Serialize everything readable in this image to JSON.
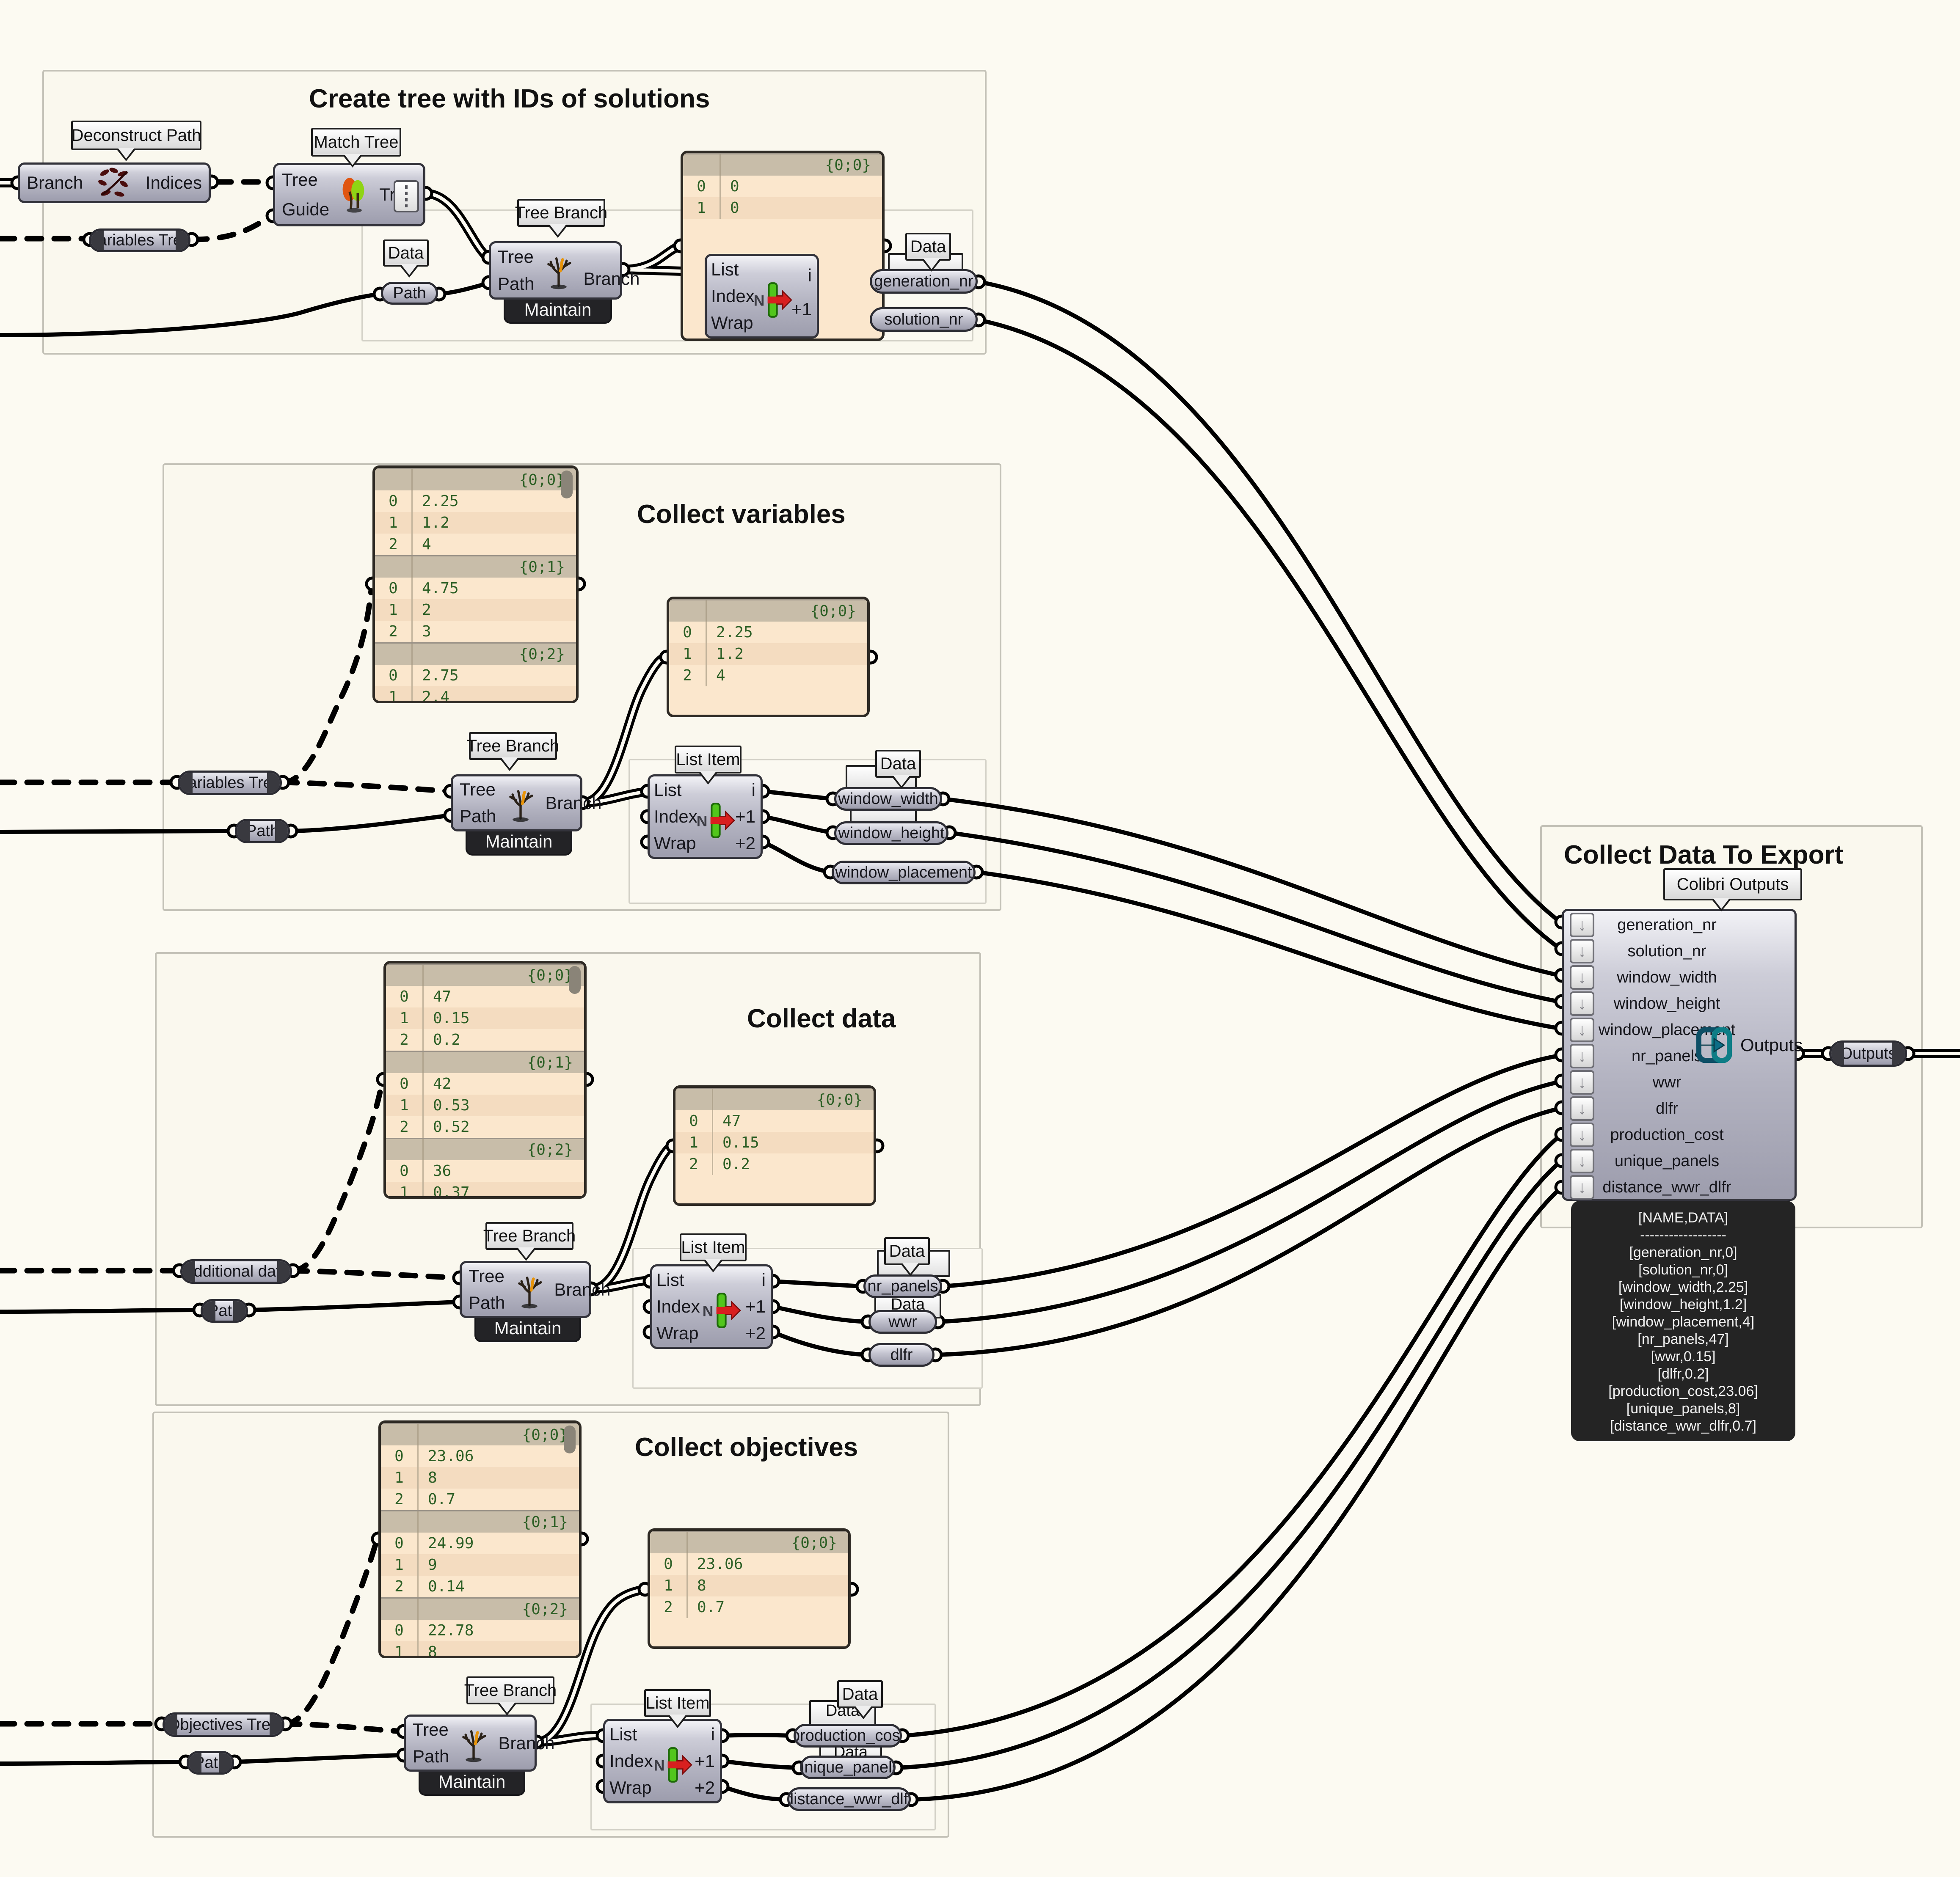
{
  "groups": {
    "g1": {
      "title": "Create tree with IDs of solutions"
    },
    "g2": {
      "title": "Collect variables"
    },
    "g3": {
      "title": "Collect data"
    },
    "g4": {
      "title": "Collect objectives"
    },
    "g5": {
      "title": "Collect Data To Export"
    }
  },
  "tooltips": {
    "deconstruct_path": "Deconstruct Path",
    "match_tree": "Match Tree",
    "tree_branch": "Tree Branch",
    "list_item": "List Item",
    "data": "Data",
    "colibri_outputs": "Colibri Outputs"
  },
  "components": {
    "deconstruct_path": {
      "input": "Branch",
      "output": "Indices"
    },
    "match_tree": {
      "inputs": [
        "Tree",
        "Guide"
      ],
      "output": "Tree"
    },
    "tree_branch": {
      "inputs": [
        "Tree",
        "Path"
      ],
      "output": "Branch",
      "footer": "Maintain"
    },
    "list_item": {
      "inputs": [
        "List",
        "Index",
        "Wrap"
      ],
      "icon_letter": "N",
      "outputs": [
        "i",
        "+1",
        "+2"
      ]
    },
    "colibri": {
      "inputs": [
        "generation_nr",
        "solution_nr",
        "window_width",
        "window_height",
        "window_placement",
        "nr_panels",
        "wwr",
        "dlfr",
        "production_cost",
        "unique_panels",
        "distance_wwr_dlfr"
      ],
      "output": "Outputs"
    }
  },
  "params": {
    "variables_tree": "Variables Tree",
    "additional_data": "Additional data",
    "objectives_tree": "Objectives Tree",
    "path": "Path",
    "generation_nr": "generation_nr",
    "solution_nr": "solution_nr",
    "window_width": "window_width",
    "window_height": "window_height",
    "window_placement": "window_placement",
    "nr_panels": "nr_panels",
    "wwr": "wwr",
    "dlfr": "dlfr",
    "production_cost": "production_cost",
    "unique_panels": "unique_panels",
    "distance_wwr_dlfr": "distance_wwr_dlfr",
    "outputs": "Outputs"
  },
  "panels": {
    "ids": {
      "rows": [
        {
          "c": "phdr",
          "i": "",
          "v": "{0;0}"
        },
        {
          "c": "prow",
          "i": "0",
          "v": "0"
        },
        {
          "c": "prow alt",
          "i": "1",
          "v": "0"
        }
      ]
    },
    "variables_big": {
      "rows": [
        {
          "c": "phdr",
          "i": "",
          "v": "{0;0}"
        },
        {
          "c": "prow",
          "i": "0",
          "v": "2.25"
        },
        {
          "c": "prow alt",
          "i": "1",
          "v": "1.2"
        },
        {
          "c": "prow",
          "i": "2",
          "v": "4"
        },
        {
          "c": "phdr",
          "i": "",
          "v": "{0;1}"
        },
        {
          "c": "prow",
          "i": "0",
          "v": "4.75"
        },
        {
          "c": "prow alt",
          "i": "1",
          "v": "2"
        },
        {
          "c": "prow",
          "i": "2",
          "v": "3"
        },
        {
          "c": "phdr",
          "i": "",
          "v": "{0;2}"
        },
        {
          "c": "prow",
          "i": "0",
          "v": "2.75"
        },
        {
          "c": "prow alt",
          "i": "1",
          "v": "2.4"
        }
      ]
    },
    "variables_small": {
      "rows": [
        {
          "c": "phdr",
          "i": "",
          "v": "{0;0}"
        },
        {
          "c": "prow",
          "i": "0",
          "v": "2.25"
        },
        {
          "c": "prow alt",
          "i": "1",
          "v": "1.2"
        },
        {
          "c": "prow",
          "i": "2",
          "v": "4"
        }
      ]
    },
    "data_big": {
      "rows": [
        {
          "c": "phdr",
          "i": "",
          "v": "{0;0}"
        },
        {
          "c": "prow",
          "i": "0",
          "v": "47"
        },
        {
          "c": "prow alt",
          "i": "1",
          "v": "0.15"
        },
        {
          "c": "prow",
          "i": "2",
          "v": "0.2"
        },
        {
          "c": "phdr",
          "i": "",
          "v": "{0;1}"
        },
        {
          "c": "prow",
          "i": "0",
          "v": "42"
        },
        {
          "c": "prow alt",
          "i": "1",
          "v": "0.53"
        },
        {
          "c": "prow",
          "i": "2",
          "v": "0.52"
        },
        {
          "c": "phdr",
          "i": "",
          "v": "{0;2}"
        },
        {
          "c": "prow",
          "i": "0",
          "v": "36"
        },
        {
          "c": "prow alt",
          "i": "1",
          "v": "0.37"
        }
      ]
    },
    "data_small": {
      "rows": [
        {
          "c": "phdr",
          "i": "",
          "v": "{0;0}"
        },
        {
          "c": "prow",
          "i": "0",
          "v": "47"
        },
        {
          "c": "prow alt",
          "i": "1",
          "v": "0.15"
        },
        {
          "c": "prow",
          "i": "2",
          "v": "0.2"
        }
      ]
    },
    "objectives_big": {
      "rows": [
        {
          "c": "phdr",
          "i": "",
          "v": "{0;0}"
        },
        {
          "c": "prow",
          "i": "0",
          "v": "23.06"
        },
        {
          "c": "prow alt",
          "i": "1",
          "v": "8"
        },
        {
          "c": "prow",
          "i": "2",
          "v": "0.7"
        },
        {
          "c": "phdr",
          "i": "",
          "v": "{0;1}"
        },
        {
          "c": "prow",
          "i": "0",
          "v": "24.99"
        },
        {
          "c": "prow alt",
          "i": "1",
          "v": "9"
        },
        {
          "c": "prow",
          "i": "2",
          "v": "0.14"
        },
        {
          "c": "phdr",
          "i": "",
          "v": "{0;2}"
        },
        {
          "c": "prow",
          "i": "0",
          "v": "22.78"
        },
        {
          "c": "prow alt",
          "i": "1",
          "v": "8"
        }
      ]
    },
    "objectives_small": {
      "rows": [
        {
          "c": "phdr",
          "i": "",
          "v": "{0;0}"
        },
        {
          "c": "prow",
          "i": "0",
          "v": "23.06"
        },
        {
          "c": "prow alt",
          "i": "1",
          "v": "8"
        },
        {
          "c": "prow",
          "i": "2",
          "v": "0.7"
        }
      ]
    }
  },
  "export_panel": {
    "lines": [
      "[NAME,DATA]",
      "------------------",
      "[generation_nr,0]",
      "[solution_nr,0]",
      "[window_width,2.25]",
      "[window_height,1.2]",
      "[window_placement,4]",
      "[nr_panels,47]",
      "[wwr,0.15]",
      "[dlfr,0.2]",
      "[production_cost,23.06]",
      "[unique_panels,8]",
      "[distance_wwr_dlfr,0.7]"
    ]
  },
  "colors": {
    "panel_text_green": "#2c5f25",
    "panel_bg": "#fbe7cd",
    "wire": "#000000",
    "output_icon_teal": "#0d5c6e"
  }
}
